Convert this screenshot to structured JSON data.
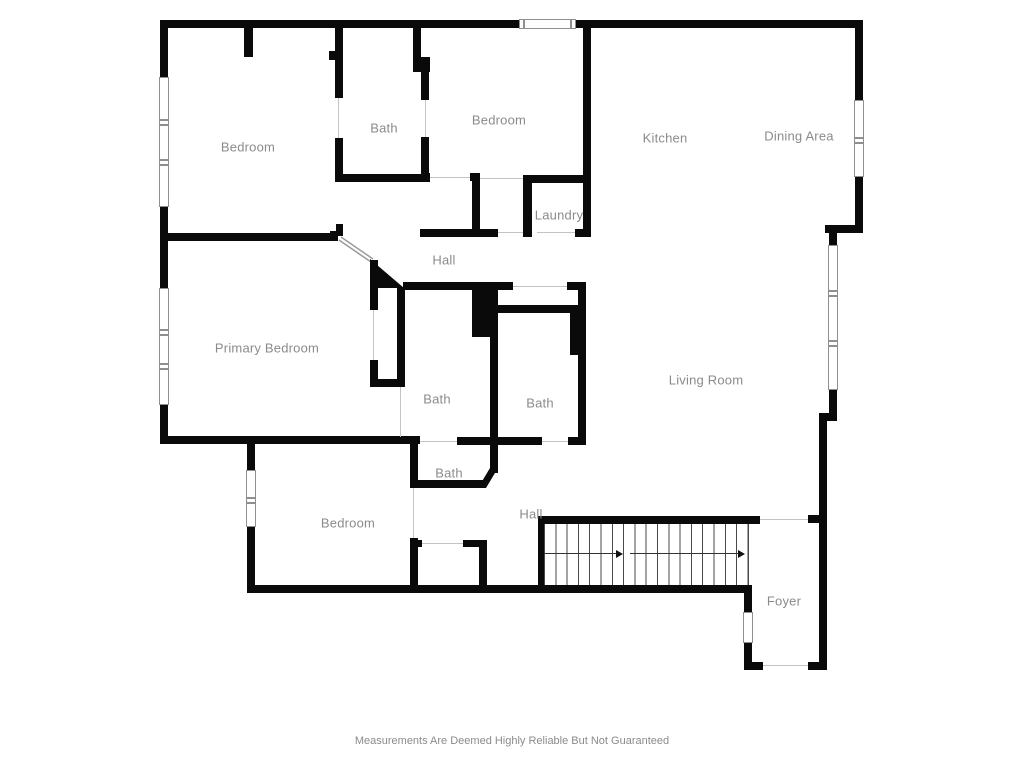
{
  "floor_plan": {
    "labels": {
      "bedroom_top_left": "Bedroom",
      "bath_top": "Bath",
      "bedroom_top_center": "Bedroom",
      "kitchen": "Kitchen",
      "dining_area": "Dining Area",
      "laundry": "Laundry",
      "hall_upper": "Hall",
      "primary_bedroom": "Primary Bedroom",
      "bath_center_left": "Bath",
      "bath_center_right": "Bath",
      "living_room": "Living Room",
      "bath_lower": "Bath",
      "bedroom_lower": "Bedroom",
      "hall_lower": "Hall",
      "foyer": "Foyer"
    },
    "footer": {
      "disclaimer": "Measurements Are Deemed Highly Reliable But Not Guaranteed"
    },
    "stairs": {
      "direction": "right"
    },
    "colors": {
      "walls": "#0a0a0a",
      "labels": "#8b8b8b",
      "background": "#ffffff"
    }
  }
}
